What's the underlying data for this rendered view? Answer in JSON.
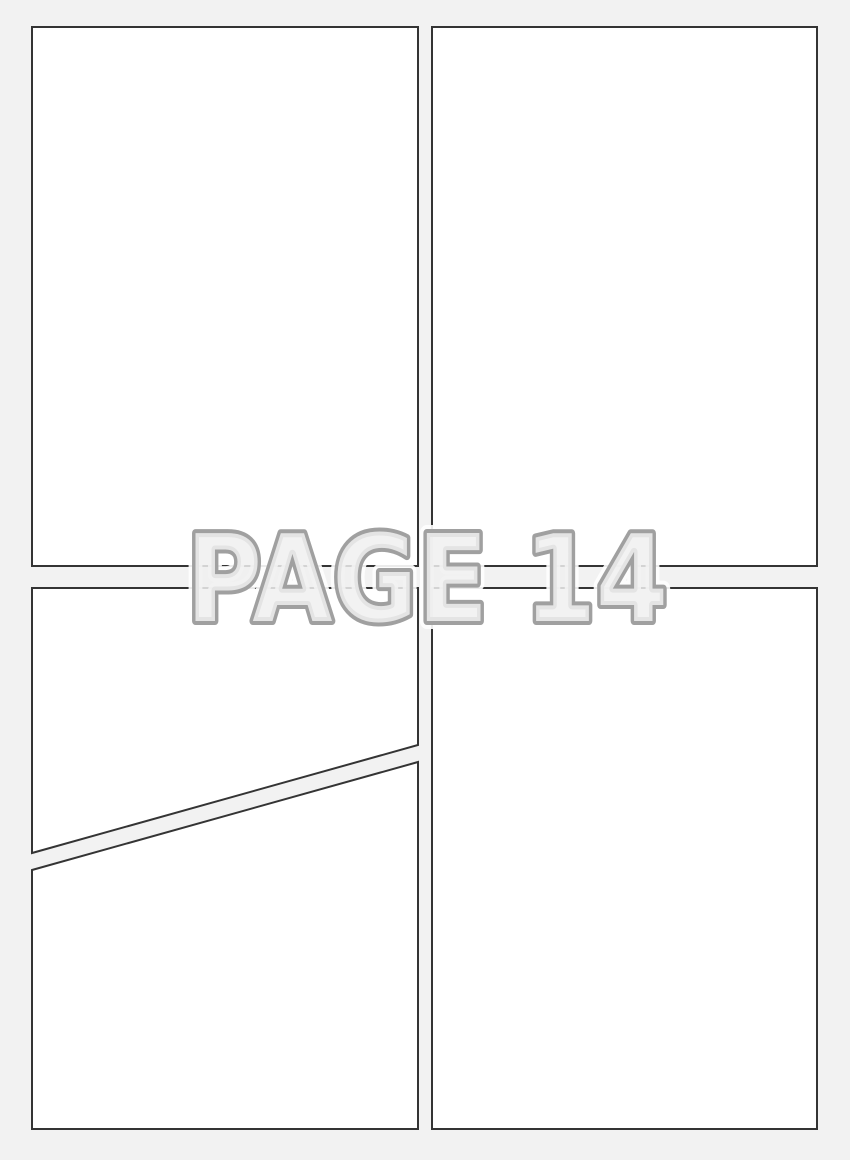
{
  "page": {
    "title_label": "PAGE 14",
    "colors": {
      "background": "#f2f2f2",
      "panel_fill": "#ffffff",
      "panel_border": "#343434",
      "title_outline": "#a0a0a0",
      "title_fill": "#f0f0f0",
      "title_halo": "#ffffff"
    }
  },
  "panels": [
    {
      "name": "top-left"
    },
    {
      "name": "top-right"
    },
    {
      "name": "bottom-left-upper"
    },
    {
      "name": "bottom-left-lower"
    },
    {
      "name": "bottom-right"
    }
  ]
}
